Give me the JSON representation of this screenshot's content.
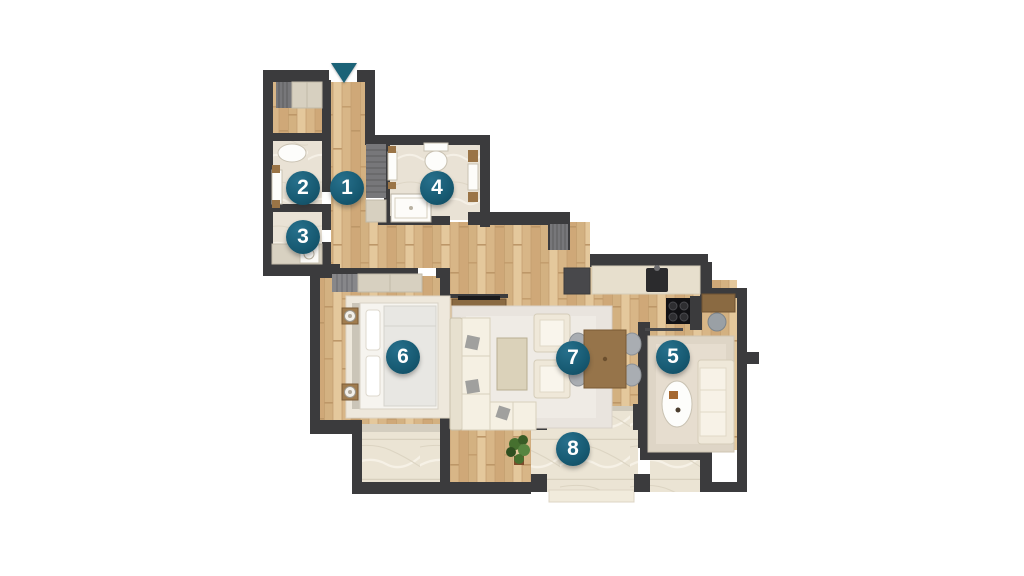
{
  "floorplan": {
    "colors": {
      "wall": "#3b3b3d",
      "badge": "#175a72",
      "badge_text": "#ffffff",
      "entrance_arrow": "#1b6277"
    },
    "entrance": {
      "icon": "entrance-arrow-down",
      "x": 344,
      "y": 63
    },
    "markers": [
      {
        "number": "1",
        "x": 347,
        "y": 188
      },
      {
        "number": "2",
        "x": 303,
        "y": 188
      },
      {
        "number": "3",
        "x": 303,
        "y": 237
      },
      {
        "number": "4",
        "x": 437,
        "y": 188
      },
      {
        "number": "5",
        "x": 673,
        "y": 357
      },
      {
        "number": "6",
        "x": 403,
        "y": 357
      },
      {
        "number": "7",
        "x": 573,
        "y": 358
      },
      {
        "number": "8",
        "x": 573,
        "y": 449
      }
    ]
  }
}
